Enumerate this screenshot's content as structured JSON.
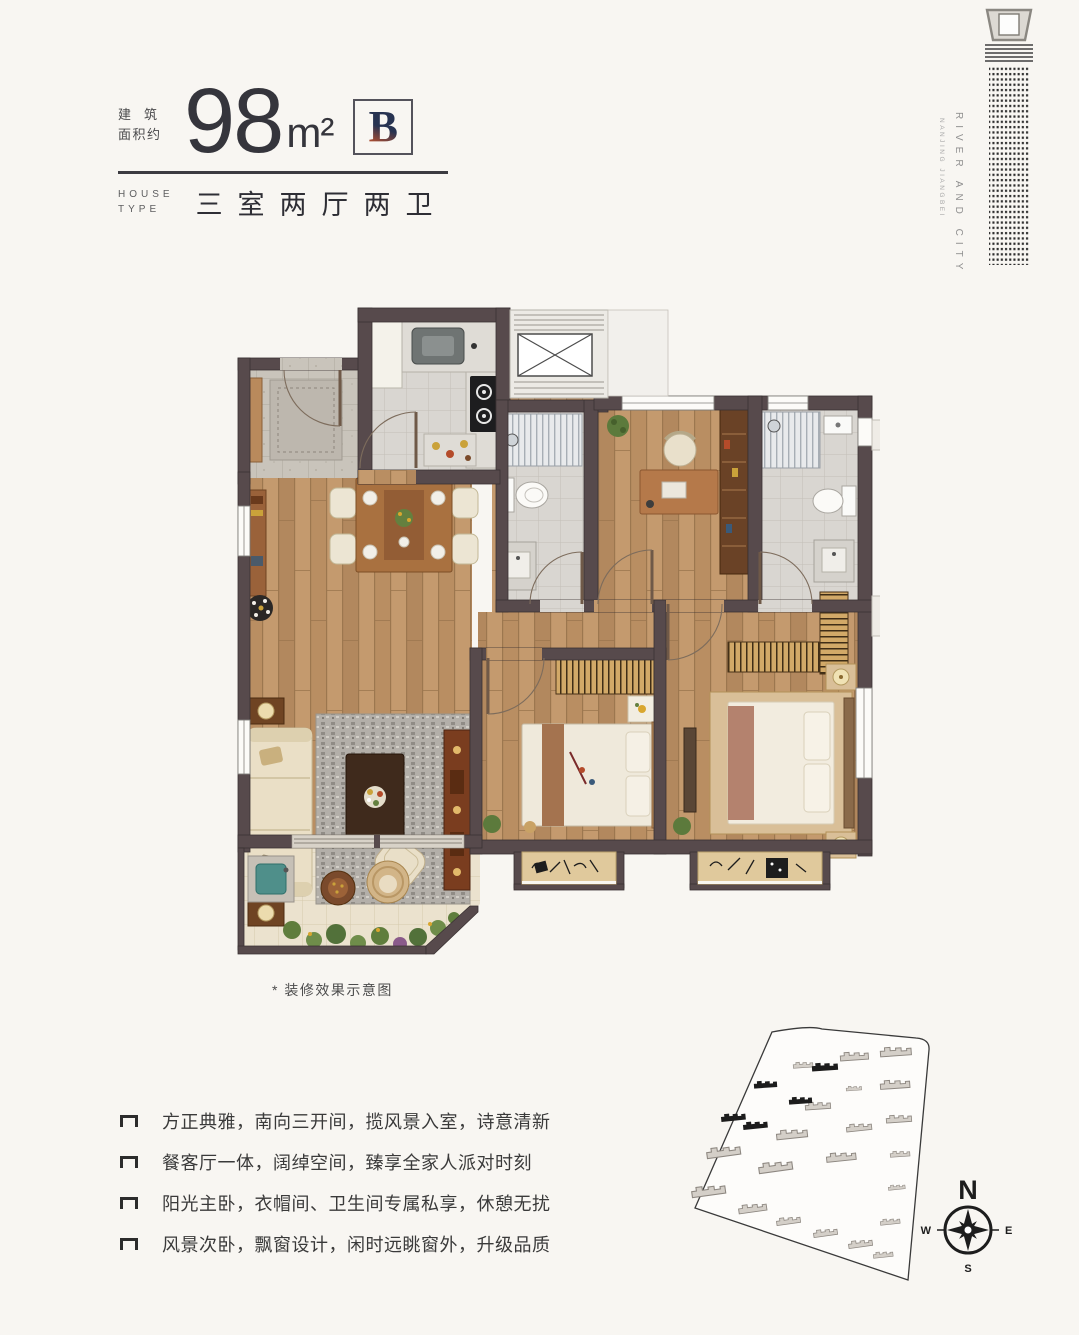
{
  "header": {
    "area_label_line1": "建筑",
    "area_label_line2": "面积约",
    "area_value": "98",
    "area_unit": "m²",
    "unit_badge": "B",
    "house_label_line1": "HOUSE",
    "house_label_line2": "TYPE",
    "house_type": "三室两厅两卫"
  },
  "brand": {
    "line1": "RIVER AND CITY",
    "line2": "NANJING JIANGBEI"
  },
  "floor_plan": {
    "caption": "* 装修效果示意图"
  },
  "features": [
    "方正典雅，南向三开间，揽风景入室，诗意清新",
    "餐客厅一体，阔绰空间，臻享全家人派对时刻",
    "阳光主卧，衣帽间、卫生间专属私享，休憩无扰",
    "风景次卧，飘窗设计，闲时远眺窗外，升级品质"
  ],
  "compass": {
    "north": "N",
    "east": "E",
    "south": "S",
    "west": "W"
  },
  "colors": {
    "badge_navy": "#273351",
    "badge_orange": "#b8502e",
    "wall": "#574a4c",
    "wood_floor": "#c2986c",
    "tile": "#d9d6d1",
    "balcony_tile": "#ebe2ce",
    "text_dark": "#3b3b42"
  }
}
